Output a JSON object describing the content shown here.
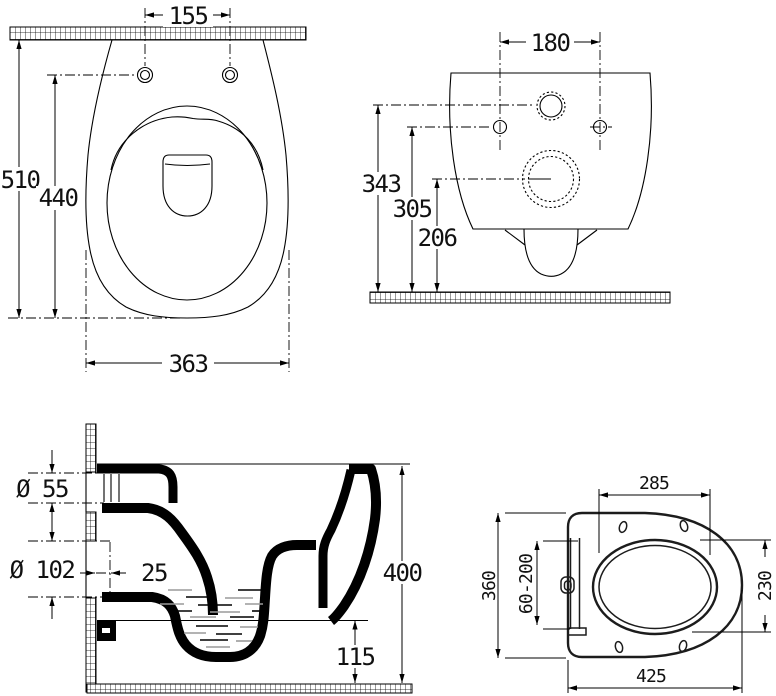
{
  "drawing_type": "technical-dimension-drawing",
  "subject": "wall-hung toilet with seat, four orthographic views",
  "colors": {
    "line": "#000000",
    "water_hatch": "#9a9a9a",
    "background": "#ffffff"
  },
  "views": {
    "top": {
      "label": "top view",
      "dims": {
        "hole_spacing": "155",
        "overall_depth": "510",
        "holes_to_front": "440",
        "bowl_width": "363"
      }
    },
    "rear": {
      "label": "rear view",
      "dims": {
        "hole_spacing": "180",
        "inlet_height": "343",
        "hole_height": "305",
        "outlet_height": "206"
      }
    },
    "section": {
      "label": "side section view",
      "dims": {
        "inlet_diameter": "Ø 55",
        "outlet_diameter": "Ø 102",
        "outlet_wall_offset": "25",
        "rim_height": "400",
        "underside_height": "115"
      }
    },
    "seat": {
      "label": "seat top view",
      "dims": {
        "opening_length": "285",
        "seat_width": "360",
        "hinge_adjust_range": "60-200",
        "opening_width": "230",
        "seat_length": "425"
      }
    }
  }
}
